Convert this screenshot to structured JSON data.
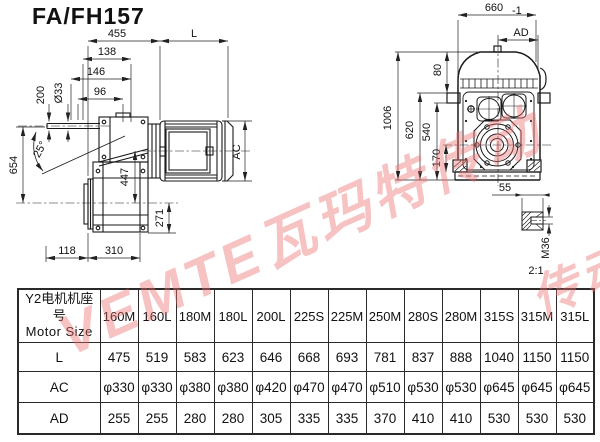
{
  "title": "FA/FH157",
  "watermark": {
    "text": "VEMTE瓦玛特传动",
    "fragment": "传动",
    "color": "#e96e6e"
  },
  "drawing": {
    "side": {
      "total_width": "455",
      "motor_len": "L",
      "s138": "138",
      "s146": "146",
      "s96": "96",
      "dia": "Ø33",
      "s200": "200",
      "angle": "25°",
      "s654": "654",
      "s447": "447",
      "s271": "271",
      "s118": "118",
      "s310": "310",
      "ac": "AC"
    },
    "front": {
      "f660": "660",
      "tol": "-1",
      "ad": "AD",
      "f80": "80",
      "f1006": "1006",
      "f620": "620",
      "f540": "540",
      "f170": "170",
      "f55": "55",
      "m36": "M36",
      "scale": "2:1"
    }
  },
  "table": {
    "header_cn": "Y2电机机座号",
    "header_en": "Motor Size",
    "columns": [
      "160M",
      "160L",
      "180M",
      "180L",
      "200L",
      "225S",
      "225M",
      "250M",
      "280S",
      "280M",
      "315S",
      "315M",
      "315L"
    ],
    "rows": [
      {
        "label": "L",
        "values": [
          "475",
          "519",
          "583",
          "623",
          "646",
          "668",
          "693",
          "781",
          "837",
          "888",
          "1040",
          "1150",
          "1150"
        ]
      },
      {
        "label": "AC",
        "values": [
          "φ330",
          "φ330",
          "φ380",
          "φ380",
          "φ420",
          "φ470",
          "φ470",
          "φ510",
          "φ530",
          "φ530",
          "φ645",
          "φ645",
          "φ645"
        ]
      },
      {
        "label": "AD",
        "values": [
          "255",
          "255",
          "280",
          "280",
          "305",
          "335",
          "335",
          "370",
          "410",
          "410",
          "530",
          "530",
          "530"
        ]
      }
    ]
  }
}
